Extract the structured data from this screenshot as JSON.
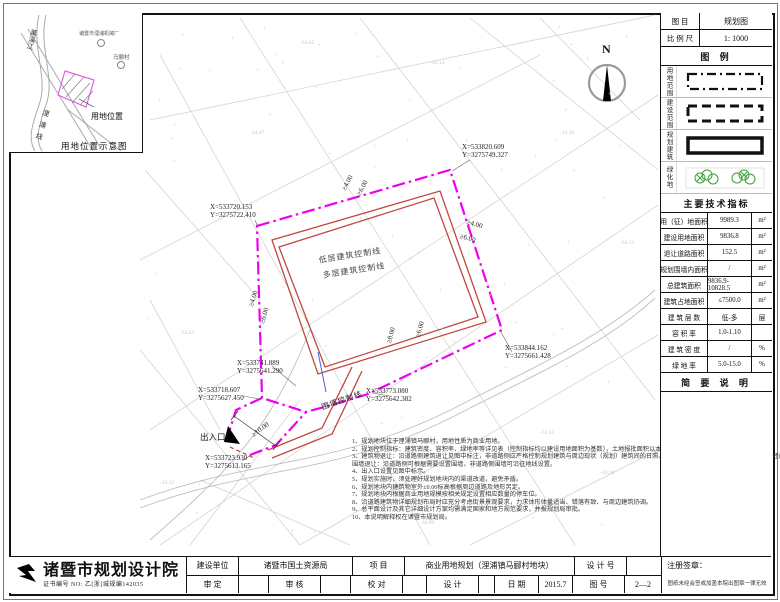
{
  "doc": {
    "sheet_type_label": "图  目",
    "sheet_type_value": "规划图",
    "scale_label": "比 例 尺",
    "scale_value": "1: 1000"
  },
  "legend": {
    "title": "图 例",
    "items": [
      {
        "label": "用地范围",
        "symbol": "dashdot-rect"
      },
      {
        "label": "建设范围",
        "symbol": "dashed-rect"
      },
      {
        "label": "规划建筑",
        "symbol": "solid-rect"
      },
      {
        "label": "绿化地",
        "symbol": "trees"
      }
    ]
  },
  "indicators": {
    "title": "主要技术指标",
    "rows": [
      {
        "label": "用（征）地面积",
        "value": "9989.3",
        "unit": "m²"
      },
      {
        "label": "建设用地面积",
        "value": "9836.8",
        "unit": "m²"
      },
      {
        "label": "退让道路面积",
        "value": "152.5",
        "unit": "m²"
      },
      {
        "label": "规划围墙内面积",
        "value": "/",
        "unit": "m²"
      },
      {
        "label": "总建筑面积",
        "value": "9836.9-10828.5",
        "unit": "m²"
      },
      {
        "label": "建筑占地面积",
        "value": "≤7500.0",
        "unit": "m²"
      },
      {
        "label": "建 筑 层 数",
        "value": "低-多",
        "unit": "层"
      },
      {
        "label": "容  积  率",
        "value": "1.0-1.10",
        "unit": ""
      },
      {
        "label": "建 筑 密 度",
        "value": "/",
        "unit": "%"
      },
      {
        "label": "绿  地  率",
        "value": "5.0-15.0",
        "unit": "%"
      }
    ]
  },
  "notes_panel": {
    "title": "简 要 说 明"
  },
  "inset": {
    "title": "用地位置示意图",
    "site_label": "用地位置",
    "river_label": "萬溪江",
    "road_label": "浬浦线",
    "poi_top": "诸暨市浬浦机械厂",
    "poi_village": "马郦村"
  },
  "map": {
    "north": "N",
    "low_rise_label": "低层建筑控制线",
    "multi_storey_label": "多层建筑控制线",
    "wall_label": "围墙控制线",
    "entrance_label": "出入口",
    "coords": [
      {
        "x": "X=533720.153",
        "y": "Y=3275722.410"
      },
      {
        "x": "X=533820.609",
        "y": "Y=3275749.327"
      },
      {
        "x": "X=533844.162",
        "y": "Y=3275661.428"
      },
      {
        "x": "X=533741.889",
        "y": "Y=3275641.290"
      },
      {
        "x": "X=533718.607",
        "y": "Y=3275627.450"
      },
      {
        "x": "X=533773.080",
        "y": "Y=3275642.382"
      },
      {
        "x": "X=533723.930",
        "y": "Y=3275613.165"
      }
    ],
    "setbacks": [
      "≥4.00",
      "≥6.00",
      "≥4.00",
      "≥6.00",
      "≥4.00",
      "≥6.00",
      "≥8.00",
      "≥6.00",
      "≥10.00"
    ],
    "elevations": [
      "-34.05",
      "-34.14",
      "-34.28",
      "-34.12",
      "-34.47",
      "-34.23",
      "-34.35",
      "-34.18",
      "-34.09",
      "-34.31"
    ],
    "notes": [
      "1、规划地块位于浬浦镇马郦村，用地性质为商业用地。",
      "2、规划控制指标：建筑密度、容积率、绿地率等详见表（控制指标均以建设用地面积为基数），土地报批面积以本图为准。",
      "3、建筑物退让：沿道路侧建筑退让见图中标注，非道路侧应严格控制规划建筑与周边现状（规划）建筑间的日照、消防等要求（具体数值详见附图），同时还应满足建筑总平面设计规范要求以及《诸暨市城乡规划管理技术规定》（试行）中的要求。",
      "围墙退让：沿道路侧可根据需要设置围墙，非道路侧围墙可沿征地线设置。",
      "4、出入口设置见图中标示。",
      "5、规划实施时，须处理好规划地块内的渠道改道，避免矛盾。",
      "6、规划地块内建筑物室外±0.00标高根据周边道路及地形另定。",
      "7、规划地块内根据商业用地规模按相关规定设置相应数量的停车位。",
      "8、沿道路建筑物详细规划布局时应充分考虑街景景观要求，力求体形体量适当、错落有致、与周边建筑协调。",
      "9、总平面设计及其它详细设计方案均需满足国家和地方规范要求，并报规划局审批。",
      "10、本说明解释权在诸暨市规划局。"
    ]
  },
  "titleblock": {
    "institute": "诸暨市规划设计院",
    "certificate": "证书编号 NO: 乙[浙]城规编142035",
    "client_label": "建设单位",
    "client_value": "诸暨市国土资源局",
    "project_label": "项   目",
    "project_value": "商业用地规划（浬浦镇马郦村地块）",
    "design_no_label": "设 计 号",
    "design_no_value": "",
    "approved_label": "审   定",
    "approved_value": "",
    "reviewed_label": "审   核",
    "reviewed_value": "",
    "checked_label": "校   对",
    "checked_value": "",
    "designed_label": "设   计",
    "designed_value": "",
    "date_label": "日   期",
    "date_value": "2015.7",
    "sheet_no_label": "图   号",
    "sheet_no_value": "2—2",
    "seal_label": "注册签章：",
    "seal_note": "图纸未经会签或加盖本院出图章一律无效"
  },
  "colors": {
    "boundary_magenta": "#ee00ee",
    "building_line_red": "#c2473d",
    "green": "#3aa03a"
  }
}
